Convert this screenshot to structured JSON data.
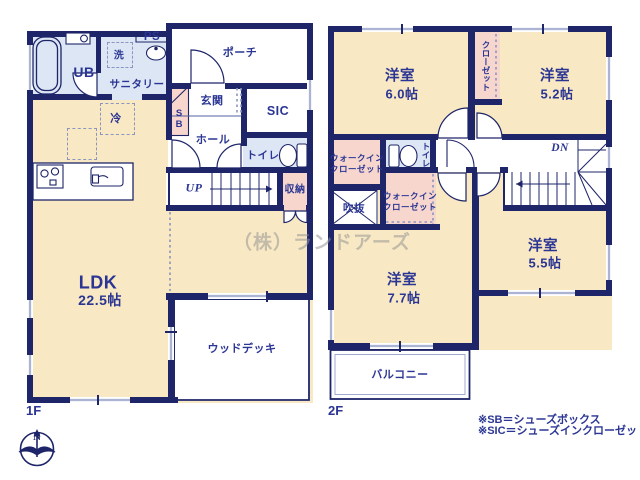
{
  "watermark": "（株）ランドアーズ",
  "compass_n": "N",
  "f1": {
    "label": "1F",
    "ldk": "LDK",
    "ldk_size": "22.5帖",
    "ub": "UB",
    "sanitary": "サニタリー",
    "wash": "洗",
    "ps": "PS",
    "fridge": "冷",
    "porch": "ポーチ",
    "genkan": "玄関",
    "sic": "SIC",
    "sb": "SB",
    "hall": "ホール",
    "toilet": "トイレ",
    "up": "UP",
    "storage": "収納",
    "wood_deck": "ウッドデッキ"
  },
  "f2": {
    "label": "2F",
    "room_nw": "洋室",
    "room_nw_size": "6.0帖",
    "closet": "クローゼット",
    "room_ne": "洋室",
    "room_ne_size": "5.2帖",
    "wic1_l1": "ウォークイン",
    "wic1_l2": "クローゼット",
    "toilet": "トイレ",
    "wic2_l1": "ウォークイン",
    "wic2_l2": "クローゼット",
    "void": "吹抜",
    "dn": "DN",
    "room_s": "洋室",
    "room_s_size": "7.7帖",
    "room_se": "洋室",
    "room_se_size": "5.5帖",
    "balcony": "バルコニー"
  },
  "notes": {
    "sb": "※SB＝シューズボックス",
    "sic": "※SIC＝シューズインクローゼット"
  },
  "colors": {
    "wall": "#1e2569",
    "text": "#2b3694",
    "room_cream": "#f8e8c3",
    "room_blue": "#dce6f4",
    "room_pink": "#f6d6cd",
    "window_bar": "#9fa9cd"
  }
}
